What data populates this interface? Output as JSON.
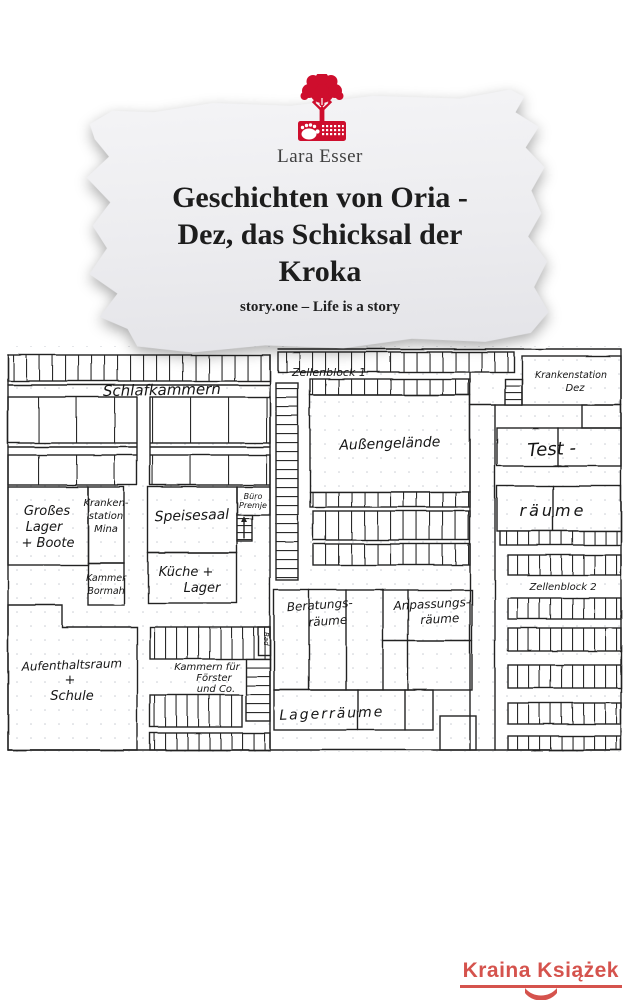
{
  "cover": {
    "author": "Lara Esser",
    "title_l1": "Geschichten von Oria -",
    "title_l2": "Dez, das Schicksal der",
    "title_l3": "Kroka",
    "tagline": "story.one – Life is a story"
  },
  "floorplan": {
    "schlafkammern": "Schlafkammern",
    "zellenblock1": "Zellenblock 1",
    "krankenstation_dez_l1": "Krankenstation",
    "krankenstation_dez_l2": "Dez",
    "aussengelaende": "Außengelände",
    "test": "Test -",
    "raeume": "räume",
    "zellenblock2": "Zellenblock 2",
    "grosses_lager_l1": "Großes",
    "grosses_lager_l2": "Lager",
    "grosses_lager_l3": "+ Boote",
    "krankenstation_mina_l1": "Kranken-",
    "krankenstation_mina_l2": "station",
    "krankenstation_mina_l3": "Mina",
    "speisesaal": "Speisesaal",
    "buero_l1": "Büro",
    "buero_l2": "Premje",
    "kammer_bormah_l1": "Kammer",
    "kammer_bormah_l2": "Bormah",
    "kueche_l1": "Küche +",
    "kueche_l2": "Lager",
    "aufenthaltsraum_l1": "Aufenthaltsraum",
    "aufenthaltsraum_l2": "+",
    "aufenthaltsraum_l3": "Schule",
    "kammern_foerster_l1": "Kammern für",
    "kammern_foerster_l2": "Förster",
    "kammern_foerster_l3": "und Co.",
    "beratung_l1": "Beratungs-",
    "beratung_l2": "räume",
    "anpassung_l1": "Anpassungs-",
    "anpassung_l2": "räume",
    "lagerraeume": "Lagerräume",
    "bad": "Bad"
  },
  "watermark": {
    "text": "Kraina Książek"
  },
  "colors": {
    "logo_red": "#ce0e2d",
    "ink": "#232323",
    "watermark_red": "#d5534d",
    "paper": "#ececef"
  }
}
